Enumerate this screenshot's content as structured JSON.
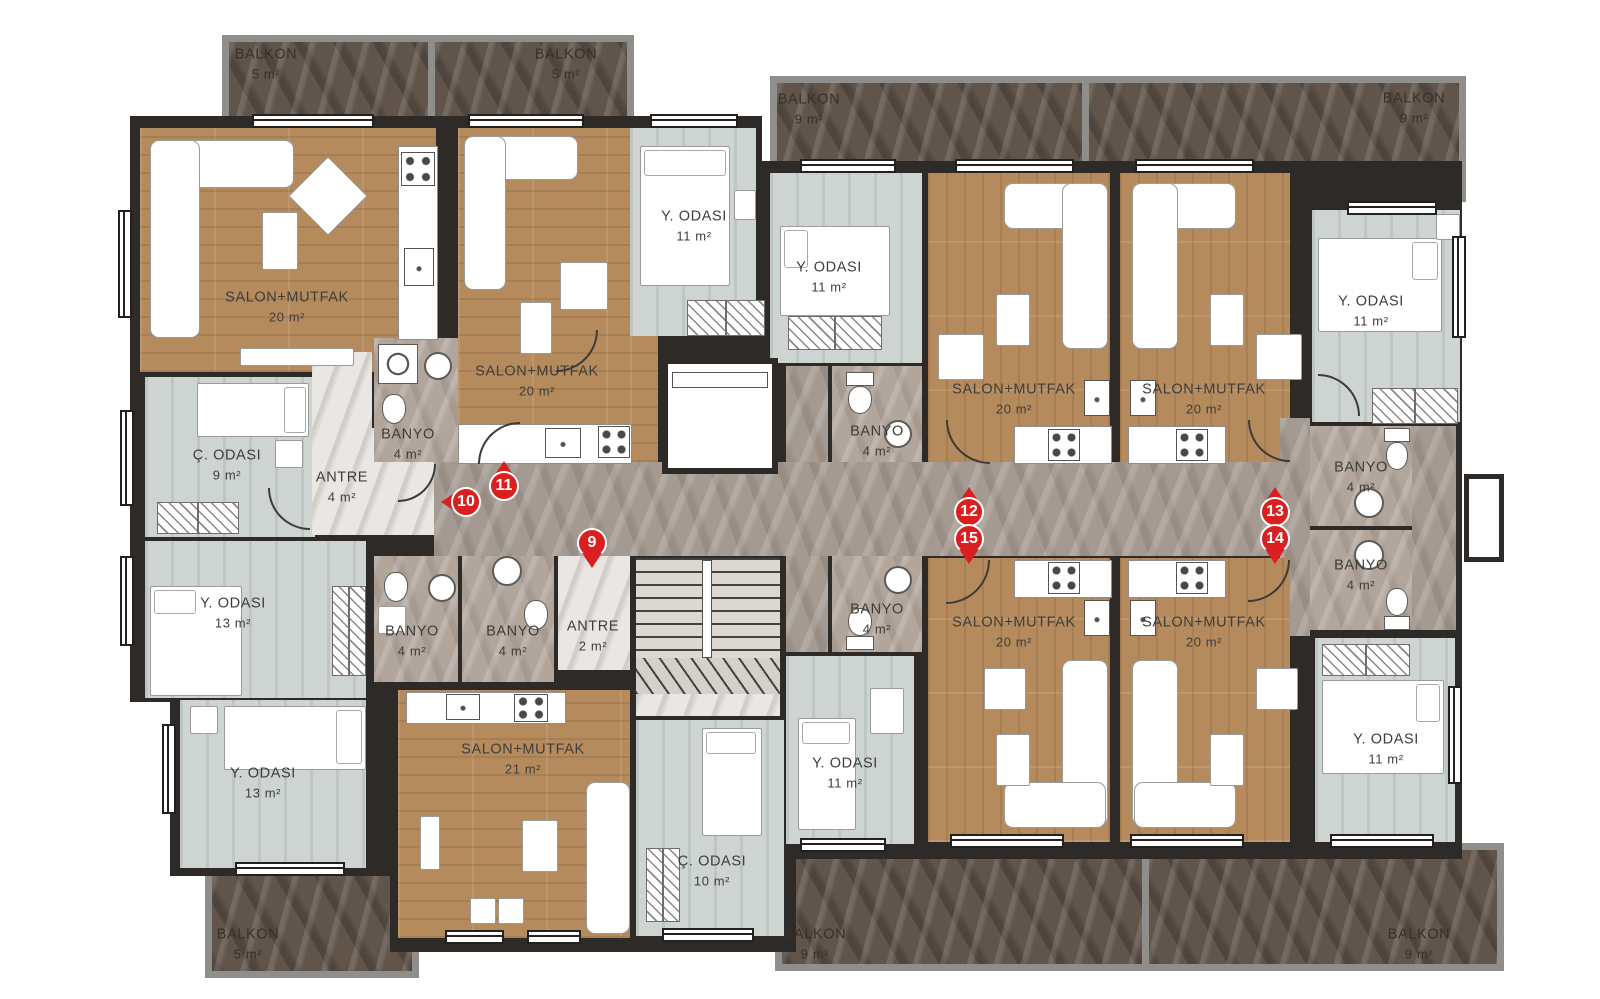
{
  "plan": {
    "kind": "residential floor plan",
    "language": "Turkish",
    "room_types": {
      "SALON+MUTFAK": "living room + kitchen",
      "Y. ODASI": "bedroom",
      "C. ODASI": "children's room",
      "BANYO": "bathroom",
      "ANTRE": "entry hall",
      "BALKON": "balcony"
    }
  },
  "colors": {
    "wall": "#2d2a27",
    "wood_floor": "#b58b5e",
    "bedroom_floor": "#ced4d1",
    "corridor_marble": "#a49a91",
    "bathroom_marble": "#b1a59c",
    "entry_marble": "#e9e6e3",
    "balcony_floor": "#60544b",
    "balcony_frame": "#908e8b",
    "marker_red": "#d91f1f"
  },
  "rooms": [
    {
      "label": "SALON+MUTFAK",
      "area": "20 m²"
    },
    {
      "label": "SALON+MUTFAK",
      "area": "20 m²"
    },
    {
      "label": "Y. ODASI",
      "area": "11 m²"
    },
    {
      "label": "Y. ODASI",
      "area": "11 m²"
    },
    {
      "label": "SALON+MUTFAK",
      "area": "20 m²"
    },
    {
      "label": "SALON+MUTFAK",
      "area": "20 m²"
    },
    {
      "label": "Y. ODASI",
      "area": "11 m²"
    },
    {
      "label": "Ç. ODASI",
      "area": "9 m²"
    },
    {
      "label": "ANTRE",
      "area": "4 m²"
    },
    {
      "label": "BANYO",
      "area": "4 m²"
    },
    {
      "label": "Y. ODASI",
      "area": "13 m²"
    },
    {
      "label": "BANYO",
      "area": "4 m²"
    },
    {
      "label": "BANYO",
      "area": "4 m²"
    },
    {
      "label": "ANTRE",
      "area": "2 m²"
    },
    {
      "label": "BANYO",
      "area": "4 m²"
    },
    {
      "label": "BANYO",
      "area": "4 m²"
    },
    {
      "label": "BANYO",
      "area": "4 m²"
    },
    {
      "label": "BANYO",
      "area": "4 m²"
    },
    {
      "label": "Y. ODASI",
      "area": "13 m²"
    },
    {
      "label": "SALON+MUTFAK",
      "area": "21 m²"
    },
    {
      "label": "Ç. ODASI",
      "area": "10 m²"
    },
    {
      "label": "Y. ODASI",
      "area": "11 m²"
    },
    {
      "label": "SALON+MUTFAK",
      "area": "20 m²"
    },
    {
      "label": "SALON+MUTFAK",
      "area": "20 m²"
    },
    {
      "label": "Y. ODASI",
      "area": "11 m²"
    }
  ],
  "balconies": [
    {
      "label": "BALKON",
      "area": "5 m²"
    },
    {
      "label": "BALKON",
      "area": "5 m²"
    },
    {
      "label": "BALKON",
      "area": "9 m²"
    },
    {
      "label": "BALKON",
      "area": "9 m²"
    },
    {
      "label": "BALKON",
      "area": "5 m²"
    },
    {
      "label": "BALKON",
      "area": "9 m²"
    },
    {
      "label": "BALKON",
      "area": "9 m²"
    }
  ],
  "markers": [
    {
      "number": "9"
    },
    {
      "number": "10"
    },
    {
      "number": "11"
    },
    {
      "number": "12"
    },
    {
      "number": "13"
    },
    {
      "number": "14"
    },
    {
      "number": "15"
    }
  ]
}
